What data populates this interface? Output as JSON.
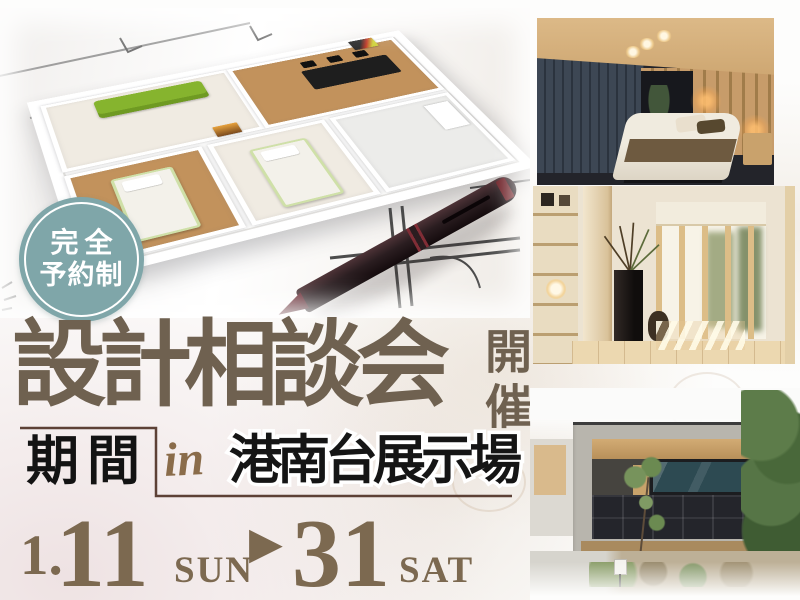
{
  "colors": {
    "accent_teal": "#7fa6a9",
    "title_brown": "#6f6150",
    "date_brown": "#7c6950",
    "script_brown": "#8a6c4a",
    "bracket_brown": "#5d4136",
    "text_black": "#151515"
  },
  "badge": {
    "line1": "完全",
    "line2": "予約制"
  },
  "title": {
    "main": "設計相談会",
    "suffix_vertical": "開催"
  },
  "period_box": {
    "label": "期間"
  },
  "venue": {
    "preposition": "in",
    "name": "港南台展示場"
  },
  "date_range": {
    "month_prefix": "1.",
    "start_day": "11",
    "start_weekday": "SUN",
    "arrow": "▶",
    "end_day": "31",
    "end_weekday": "SAT"
  }
}
